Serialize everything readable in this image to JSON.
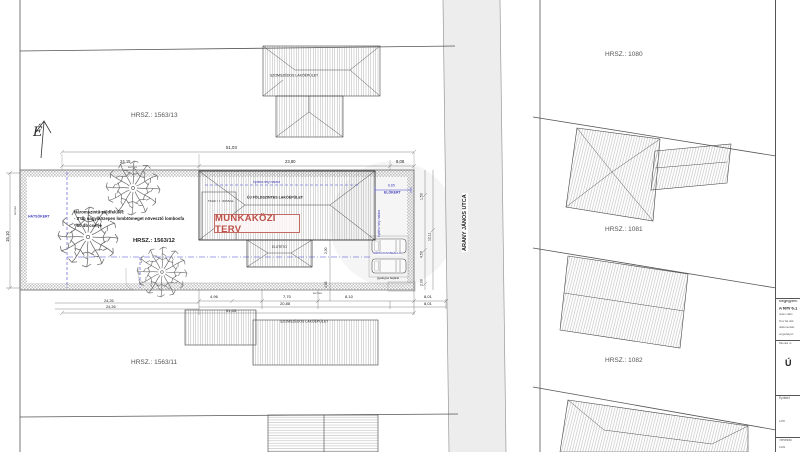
{
  "parcels": {
    "p1563_13": "HRSZ.: 1563/13",
    "p1563_12": "HRSZ.: 1563/12",
    "p1563_11": "HRSZ.: 1563/11",
    "p1080": "HRSZ.: 1080",
    "p1081": "HRSZ.: 1081",
    "p1082": "HRSZ.: 1082"
  },
  "street": {
    "name": "ARANY JÁNOS UTCA"
  },
  "north": {
    "letter": "É"
  },
  "stamp": {
    "text": "MUNKAKÖZI TERV",
    "color": "#bc4f48"
  },
  "buildings": {
    "new_house": "ÚJ FÖLDSZINTES LAKÓÉPÜLET",
    "terrace": "FEDETT TERASZ",
    "canopy": "ELŐTETŐ",
    "neighbor_top": "SZOMSZÉDOS LAKÓÉPÜLET",
    "neighbor_bottom": "SZOMSZÉDOS LAKÓÉPÜLET"
  },
  "planting_note": {
    "title": "Háromszintű zöldfelület:",
    "item1": "- 3 db nagy/közepes lombtömeget növesztő lombosfa",
    "item2": "- 60 db cserje"
  },
  "zones": {
    "rear": "HÁTSÓKERT",
    "front": "ELŐKERT",
    "envelope": "építési hely határa",
    "envelope2": "építési hely határa",
    "parking": "GÉPKOCSI BEÁLLÓ",
    "pedestrian": "gyalogos bejárat",
    "fence_top": "kerítés",
    "fence_left": "kerítés",
    "fence_bottom": "kerítés"
  },
  "dims": {
    "top_total": "51,03",
    "top_a": "24,15",
    "top_b": "23,80",
    "top_c": "8,08",
    "left_total": "15,10",
    "front": "6,65",
    "right_a": "1,50",
    "right_b": "12,11",
    "right_c": "4,50",
    "right_d": "2,00",
    "bottom_a": "4,96",
    "bottom_b": "7,70",
    "bottom_c": "8,10",
    "bottom_d": "8,01",
    "bottom_e": "20,88",
    "bottom_f": "8,01",
    "bottom_total": "51,03",
    "bl_a": "24,26",
    "bl_b": "24,26",
    "inner_a": "2,00",
    "inner_b": "4,95"
  },
  "titleblock": {
    "r1": "Megjegyzés:",
    "r2": "A terv 6.1",
    "r3a": "Jelen válto",
    "r3b": "Terv 6a dok",
    "r3c": "dokumentác",
    "r3d": "engedélyez",
    "r4": "Munka m",
    "r4b": "Ú",
    "r5": "Építtető",
    "r6": "Cím",
    "r7": "Tervezők",
    "r7b": "Csibi"
  }
}
